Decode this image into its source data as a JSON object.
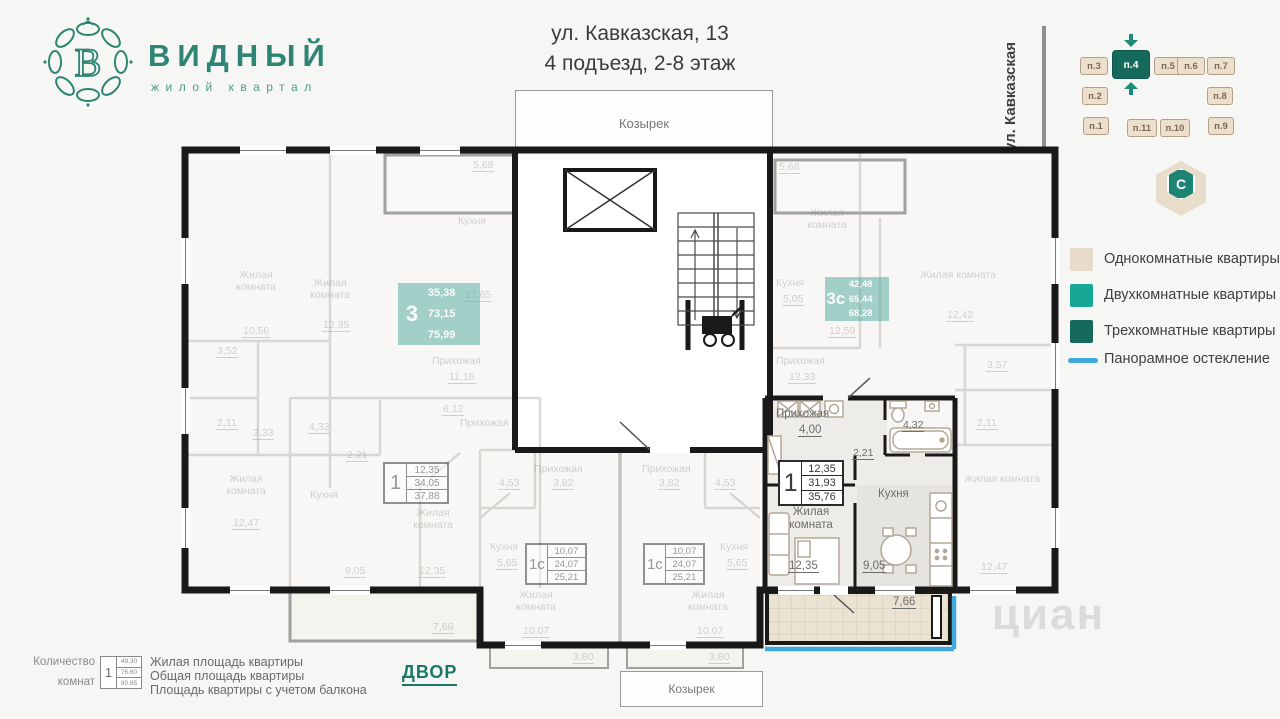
{
  "header": {
    "brand": "ВИДНЫЙ",
    "tagline": "жилой квартал",
    "logo_letter": "В",
    "address_line1": "ул. Кавказская, 13",
    "address_line2": "4 подъезд, 2-8 этаж"
  },
  "locator": {
    "street": "ул. Кавказская",
    "compass": "C",
    "active": "п.4",
    "sections": [
      {
        "label": "п.3"
      },
      {
        "label": "п.4"
      },
      {
        "label": "п.5"
      },
      {
        "label": "п.6"
      },
      {
        "label": "п.7"
      },
      {
        "label": "п.2"
      },
      {
        "label": "п.8"
      },
      {
        "label": "п.1"
      },
      {
        "label": "п.11"
      },
      {
        "label": "п.10"
      },
      {
        "label": "п.9"
      }
    ]
  },
  "legend": {
    "items": [
      {
        "label": "Однокомнатные квартиры",
        "color": "#e7dbc9"
      },
      {
        "label": "Двухкомнатные квартиры",
        "color": "#17a795"
      },
      {
        "label": "Трехкомнатные квартиры",
        "color": "#156a5c"
      },
      {
        "label": "Панорамное остекление",
        "color": "#3fa9dc"
      }
    ]
  },
  "plan": {
    "canopy_top": "Козырек",
    "canopy_bottom": "Козырек",
    "courtyard": "ДВОР",
    "watermark": "циан",
    "apt3": {
      "num": "3",
      "living": "35,38",
      "total": "73,15",
      "with_balcony": "75,99",
      "rooms": {
        "bedroom1": "Жилая комната",
        "bedroom1_area": "10,56",
        "bedroom2": "Жилая комната",
        "bedroom2_area": "12,35",
        "bedroom3": "Жилая комната",
        "bedroom3_area": "12,47",
        "kitchen": "Кухня",
        "kitchen_area": "17,65",
        "hall": "Прихожая",
        "hall_area": "11,16",
        "bath_area": "3,52",
        "wc_area": "2,11",
        "corridor_area": "3,33",
        "balcony_area": "5,68"
      }
    },
    "apt3c": {
      "num": "3с",
      "living": "42,48",
      "total": "65,44",
      "with_balcony": "68,28",
      "rooms": {
        "balcony_area": "5,68",
        "bedroom1": "Жилая комната",
        "kitchen": "Кухня",
        "kitchen_area": "5,05",
        "mid_area": "12,59",
        "hall": "Прихожая",
        "hall_area": "12,33",
        "bedroom2": "Жилая комната",
        "bedroom2_area": "12,42",
        "bath_area": "3,57",
        "wc_area": "2,11",
        "bedroom3": "Жилая комната",
        "bedroom3_area": "12,47"
      }
    },
    "apt1_left": {
      "num": "1",
      "living": "12,35",
      "total": "34,05",
      "with_balcony": "37,88",
      "rooms": {
        "bath_area": "4,32",
        "corridor_area": "2,21",
        "kitchen": "Кухня",
        "kitchen_area": "9,05",
        "room": "Жилая комната",
        "room_area": "12,35",
        "hall": "Прихожая",
        "hall_area": "6,12",
        "balcony_area": "7,66"
      }
    },
    "apt1_featured": {
      "num": "1",
      "living": "12,35",
      "total": "31,93",
      "with_balcony": "35,76",
      "rooms": {
        "hall": "Прихожая",
        "hall_area": "4,00",
        "bath_area": "4,32",
        "corridor_area": "2,21",
        "kitchen": "Кухня",
        "kitchen_area": "9,05",
        "room": "Жилая комната",
        "room_area": "12,35",
        "balcony_area": "7,66"
      }
    },
    "studio_left": {
      "num": "1с",
      "living": "10,07",
      "total": "24,07",
      "with_balcony": "25,21",
      "rooms": {
        "hall": "Прихожая",
        "hall_area": "3,82",
        "bath_area": "4,53",
        "kitchen": "Кухня",
        "kitchen_area": "5,65",
        "room": "Жилая комната",
        "room_area": "10,07",
        "balcony_area": "3,80"
      }
    },
    "studio_right": {
      "num": "1с",
      "living": "10,07",
      "total": "24,07",
      "with_balcony": "25,21",
      "rooms": {
        "hall": "Прихожая",
        "hall_area": "3,82",
        "bath_area": "4,53",
        "kitchen": "Кухня",
        "kitchen_area": "5,65",
        "room": "Жилая комната",
        "room_area": "10,07",
        "balcony_area": "3,80"
      }
    }
  },
  "footnote": {
    "rooms_caption_1": "Количество",
    "rooms_caption_2": "комнат",
    "sample_num": "1",
    "sample_living": "49,30",
    "sample_total": "76,60",
    "sample_with_balcony": "80,95",
    "line1": "Жилая площадь квартиры",
    "line2": "Общая площадь квартиры",
    "line3": "Площадь квартиры с учетом балкона"
  }
}
